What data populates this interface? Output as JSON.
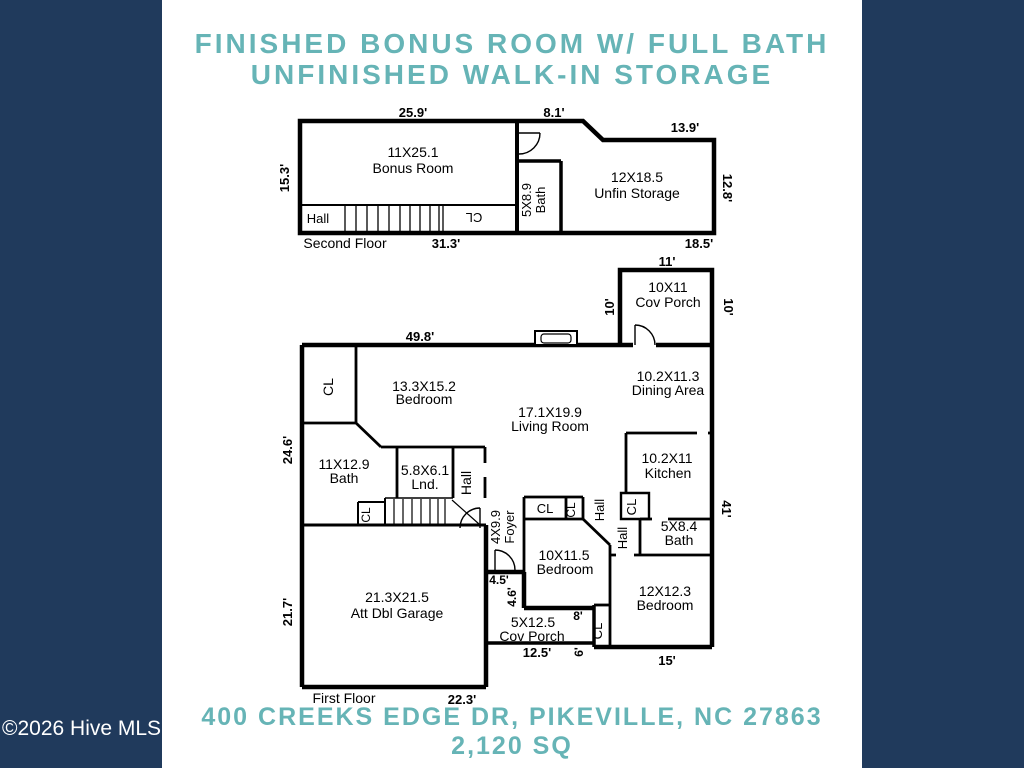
{
  "colors": {
    "frame_navy": "#203a5c",
    "paper_white": "#ffffff",
    "accent_teal": "#66b4b6",
    "plan_ink": "#000000"
  },
  "header": {
    "line1": "FINISHED BONUS ROOM W/ FULL BATH",
    "line2": "UNFINISHED WALK-IN STORAGE"
  },
  "footer": {
    "address": "400 CREEKS EDGE DR, PIKEVILLE, NC 27863",
    "area": "2,120 SQ",
    "watermark": "©2026 Hive MLS"
  },
  "floorplan": {
    "second_floor_name": "Second Floor",
    "first_floor_name": "First Floor",
    "labels": [
      {
        "n": "sf-dim-top-left",
        "t": "25.9'",
        "x": 413,
        "y": 117,
        "s": 13,
        "b": 1
      },
      {
        "n": "sf-dim-top-mid",
        "t": "8.1'",
        "x": 554,
        "y": 117,
        "s": 13,
        "b": 1
      },
      {
        "n": "sf-dim-top-right",
        "t": "13.9'",
        "x": 685,
        "y": 132,
        "s": 13,
        "b": 1
      },
      {
        "n": "sf-dim-left",
        "t": "15.3'",
        "x": 289,
        "y": 178,
        "r": -90,
        "s": 13,
        "b": 1
      },
      {
        "n": "sf-dim-right",
        "t": "12.8'",
        "x": 723,
        "y": 188,
        "r": 90,
        "s": 13,
        "b": 1
      },
      {
        "n": "sf-bonus-room-dim",
        "t": "11X25.1",
        "x": 413,
        "y": 157,
        "s": 14
      },
      {
        "n": "sf-bonus-room-name",
        "t": "Bonus Room",
        "x": 413,
        "y": 173,
        "s": 14
      },
      {
        "n": "sf-bath-dim",
        "t": "5X8.9",
        "x": 531,
        "y": 200,
        "r": -90,
        "s": 13
      },
      {
        "n": "sf-bath-name",
        "t": "Bath",
        "x": 545,
        "y": 200,
        "r": -90,
        "s": 13
      },
      {
        "n": "sf-storage-dim",
        "t": "12X18.5",
        "x": 637,
        "y": 182,
        "s": 14
      },
      {
        "n": "sf-storage-name",
        "t": "Unfin Storage",
        "x": 637,
        "y": 198,
        "s": 14
      },
      {
        "n": "sf-hall-label",
        "t": "Hall",
        "x": 318,
        "y": 223,
        "s": 13
      },
      {
        "n": "sf-cl-label",
        "t": "CL",
        "x": 474,
        "y": 213,
        "r": 180,
        "s": 13
      },
      {
        "n": "sf-floor-name",
        "t": "Second Floor",
        "x": 345,
        "y": 248,
        "s": 14
      },
      {
        "n": "sf-dim-bottom-left",
        "t": "31.3'",
        "x": 446,
        "y": 248,
        "s": 13,
        "b": 1
      },
      {
        "n": "sf-dim-bottom-right",
        "t": "18.5'",
        "x": 699,
        "y": 248,
        "s": 13,
        "b": 1
      },
      {
        "n": "ff-porch-top-dim",
        "t": "11'",
        "x": 667,
        "y": 266,
        "s": 13,
        "b": 1
      },
      {
        "n": "ff-porch-top-dim-left",
        "t": "10'",
        "x": 614,
        "y": 307,
        "r": -90,
        "s": 13,
        "b": 1
      },
      {
        "n": "ff-porch-top-dim-right",
        "t": "10'",
        "x": 724,
        "y": 307,
        "r": 90,
        "s": 13,
        "b": 1
      },
      {
        "n": "ff-porch-top-size",
        "t": "10X11",
        "x": 668,
        "y": 292,
        "s": 14
      },
      {
        "n": "ff-porch-top-name",
        "t": "Cov Porch",
        "x": 668,
        "y": 307,
        "s": 14
      },
      {
        "n": "ff-dim-top",
        "t": "49.8'",
        "x": 420,
        "y": 341,
        "s": 13,
        "b": 1
      },
      {
        "n": "ff-dim-left-upper",
        "t": "24.6'",
        "x": 292,
        "y": 450,
        "r": -90,
        "s": 13,
        "b": 1
      },
      {
        "n": "ff-dim-left-lower",
        "t": "21.7'",
        "x": 292,
        "y": 612,
        "r": -90,
        "s": 13,
        "b": 1
      },
      {
        "n": "ff-cl-northwest",
        "t": "CL",
        "x": 333,
        "y": 387,
        "r": -90,
        "s": 14
      },
      {
        "n": "ff-bedroom13-dim",
        "t": "13.3X15.2",
        "x": 424,
        "y": 391,
        "s": 14
      },
      {
        "n": "ff-bedroom13-name",
        "t": "Bedroom",
        "x": 424,
        "y": 404,
        "s": 14
      },
      {
        "n": "ff-bath11-dim",
        "t": "11X12.9",
        "x": 344,
        "y": 469,
        "s": 14
      },
      {
        "n": "ff-bath11-name",
        "t": "Bath",
        "x": 344,
        "y": 483,
        "s": 14
      },
      {
        "n": "ff-laundry-dim",
        "t": "5.8X6.1",
        "x": 425,
        "y": 475,
        "s": 14
      },
      {
        "n": "ff-laundry-name",
        "t": "Lnd.",
        "x": 425,
        "y": 489,
        "s": 14
      },
      {
        "n": "ff-hall-west-label",
        "t": "Hall",
        "x": 471,
        "y": 483,
        "r": -90,
        "s": 14
      },
      {
        "n": "ff-cl-stairs-label",
        "t": "CL",
        "x": 370,
        "y": 515,
        "r": -90,
        "s": 12
      },
      {
        "n": "ff-living-dim",
        "t": "17.1X19.9",
        "x": 550,
        "y": 417,
        "s": 14
      },
      {
        "n": "ff-living-name",
        "t": "Living Room",
        "x": 550,
        "y": 431,
        "s": 14
      },
      {
        "n": "ff-dining-dim",
        "t": "10.2X11.3",
        "x": 668,
        "y": 381,
        "s": 14
      },
      {
        "n": "ff-dining-name",
        "t": "Dining Area",
        "x": 668,
        "y": 395,
        "s": 14
      },
      {
        "n": "ff-kitchen-dim",
        "t": "10.2X11",
        "x": 667,
        "y": 463,
        "s": 14
      },
      {
        "n": "ff-kitchen-name",
        "t": "Kitchen",
        "x": 668,
        "y": 478,
        "s": 14
      },
      {
        "n": "ff-cl-kitchen-label",
        "t": "CL",
        "x": 636,
        "y": 507,
        "r": -90,
        "s": 13
      },
      {
        "n": "ff-dim-right",
        "t": "41'",
        "x": 722,
        "y": 509,
        "r": 90,
        "s": 13,
        "b": 1
      },
      {
        "n": "ff-bath5-dim",
        "t": "5X8.4",
        "x": 679,
        "y": 531,
        "s": 14
      },
      {
        "n": "ff-bath5-name",
        "t": "Bath",
        "x": 679,
        "y": 545,
        "s": 14
      },
      {
        "n": "ff-hall-mid-upper-label",
        "t": "Hall",
        "x": 604,
        "y": 510,
        "r": -90,
        "s": 13
      },
      {
        "n": "ff-hall-mid-lower-label",
        "t": "Hall",
        "x": 627,
        "y": 538,
        "r": -90,
        "s": 13
      },
      {
        "n": "ff-cl-bed10-wide-label",
        "t": "CL",
        "x": 545,
        "y": 513,
        "s": 13
      },
      {
        "n": "ff-cl-bed10-narrow-label",
        "t": "CL",
        "x": 575,
        "y": 510,
        "r": -90,
        "s": 12
      },
      {
        "n": "ff-foyer-dim",
        "t": "4X9.9",
        "x": 500,
        "y": 527,
        "r": -90,
        "s": 13
      },
      {
        "n": "ff-foyer-name",
        "t": "Foyer",
        "x": 514,
        "y": 527,
        "r": -90,
        "s": 13
      },
      {
        "n": "ff-bedroom10-dim",
        "t": "10X11.5",
        "x": 564,
        "y": 560,
        "s": 14
      },
      {
        "n": "ff-bedroom10-name",
        "t": "Bedroom",
        "x": 565,
        "y": 574,
        "s": 14
      },
      {
        "n": "ff-bedroom12-dim",
        "t": "12X12.3",
        "x": 665,
        "y": 596,
        "s": 14
      },
      {
        "n": "ff-bedroom12-name",
        "t": "Bedroom",
        "x": 665,
        "y": 610,
        "s": 14
      },
      {
        "n": "ff-cl-bed12-label",
        "t": "CL",
        "x": 602,
        "y": 631,
        "r": -90,
        "s": 13
      },
      {
        "n": "ff-dim-4-5",
        "t": "4.5'",
        "x": 499,
        "y": 584,
        "s": 12,
        "b": 1
      },
      {
        "n": "ff-dim-4-6",
        "t": "4.6'",
        "x": 516,
        "y": 597,
        "r": -90,
        "s": 12,
        "b": 1
      },
      {
        "n": "ff-dim-8",
        "t": "8'",
        "x": 578,
        "y": 620,
        "s": 12,
        "b": 1
      },
      {
        "n": "ff-porch-bottom-size",
        "t": "5X12.5",
        "x": 533,
        "y": 627,
        "s": 14
      },
      {
        "n": "ff-porch-bottom-name",
        "t": "Cov Porch",
        "x": 532,
        "y": 641,
        "s": 14
      },
      {
        "n": "ff-dim-12-5",
        "t": "12.5'",
        "x": 537,
        "y": 657,
        "s": 13,
        "b": 1
      },
      {
        "n": "ff-dim-6",
        "t": "6'",
        "x": 583,
        "y": 652,
        "r": -90,
        "s": 12,
        "b": 1
      },
      {
        "n": "ff-dim-15",
        "t": "15'",
        "x": 667,
        "y": 665,
        "s": 13,
        "b": 1
      },
      {
        "n": "ff-garage-dim",
        "t": "21.3X21.5",
        "x": 397,
        "y": 602,
        "s": 14
      },
      {
        "n": "ff-garage-name",
        "t": "Att Dbl Garage",
        "x": 397,
        "y": 618,
        "s": 14
      },
      {
        "n": "ff-floor-name",
        "t": "First Floor",
        "x": 344,
        "y": 703,
        "s": 14
      },
      {
        "n": "ff-dim-bottom",
        "t": "22.3'",
        "x": 462,
        "y": 704,
        "s": 13,
        "b": 1
      }
    ]
  }
}
